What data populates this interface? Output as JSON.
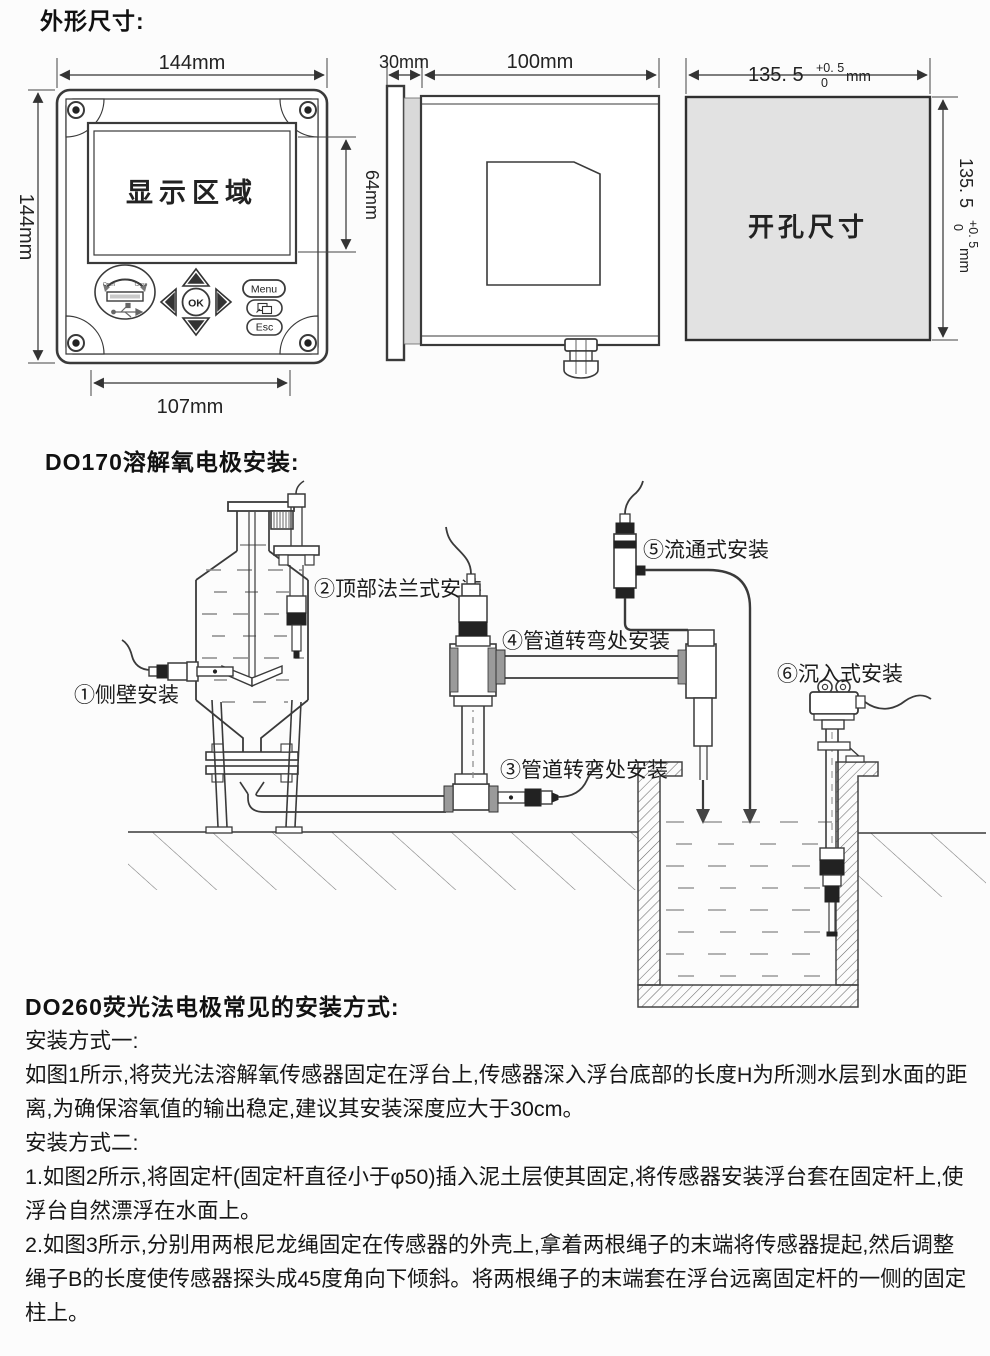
{
  "page": {
    "background": "#fcfcfc",
    "line_color": "#3a3a3a",
    "accent_gray": "#e2e2e2"
  },
  "dims": {
    "heading": "外形尺寸:",
    "front": {
      "width": "144mm",
      "height": "144mm",
      "display_area": "显示区域",
      "display_height": "64mm",
      "bottom_width": "107mm",
      "usb_open": "Open",
      "usb_close": "Close",
      "ok": "OK",
      "menu": "Menu",
      "esc": "Esc"
    },
    "side": {
      "panel_depth": "30mm",
      "body_depth": "100mm"
    },
    "cutout": {
      "label": "开孔尺寸",
      "value": "135. 5",
      "tol_plus": "+0. 5",
      "tol_zero": "0",
      "unit": "mm"
    }
  },
  "do170": {
    "heading": "DO170溶解氧电极安装:",
    "labels": {
      "l1": "①侧壁安装",
      "l2": "②顶部法兰式安装",
      "l3": "③管道转弯处安装",
      "l4": "④管道转弯处安装",
      "l5": "⑤流通式安装",
      "l6": "⑥沉入式安装"
    }
  },
  "do260": {
    "heading": "DO260荧光法电极常见的安装方式:",
    "method1_title": "安装方式一:",
    "method1_body": "如图1所示,将荧光法溶解氧传感器固定在浮台上,传感器深入浮台底部的长度H为所测水层到水面的距离,为确保溶氧值的输出稳定,建议其安装深度应大于30cm。",
    "method2_title": "安装方式二:",
    "method2_step1": "1.如图2所示,将固定杆(固定杆直径小于φ50)插入泥土层使其固定,将传感器安装浮台套在固定杆上,使浮台自然漂浮在水面上。",
    "method2_step2": "2.如图3所示,分别用两根尼龙绳固定在传感器的外壳上,拿着两根绳子的末端将传感器提起,然后调整绳子B的长度使传感器探头成45度角向下倾斜。将两根绳子的末端套在浮台远离固定杆的一侧的固定柱上。"
  }
}
